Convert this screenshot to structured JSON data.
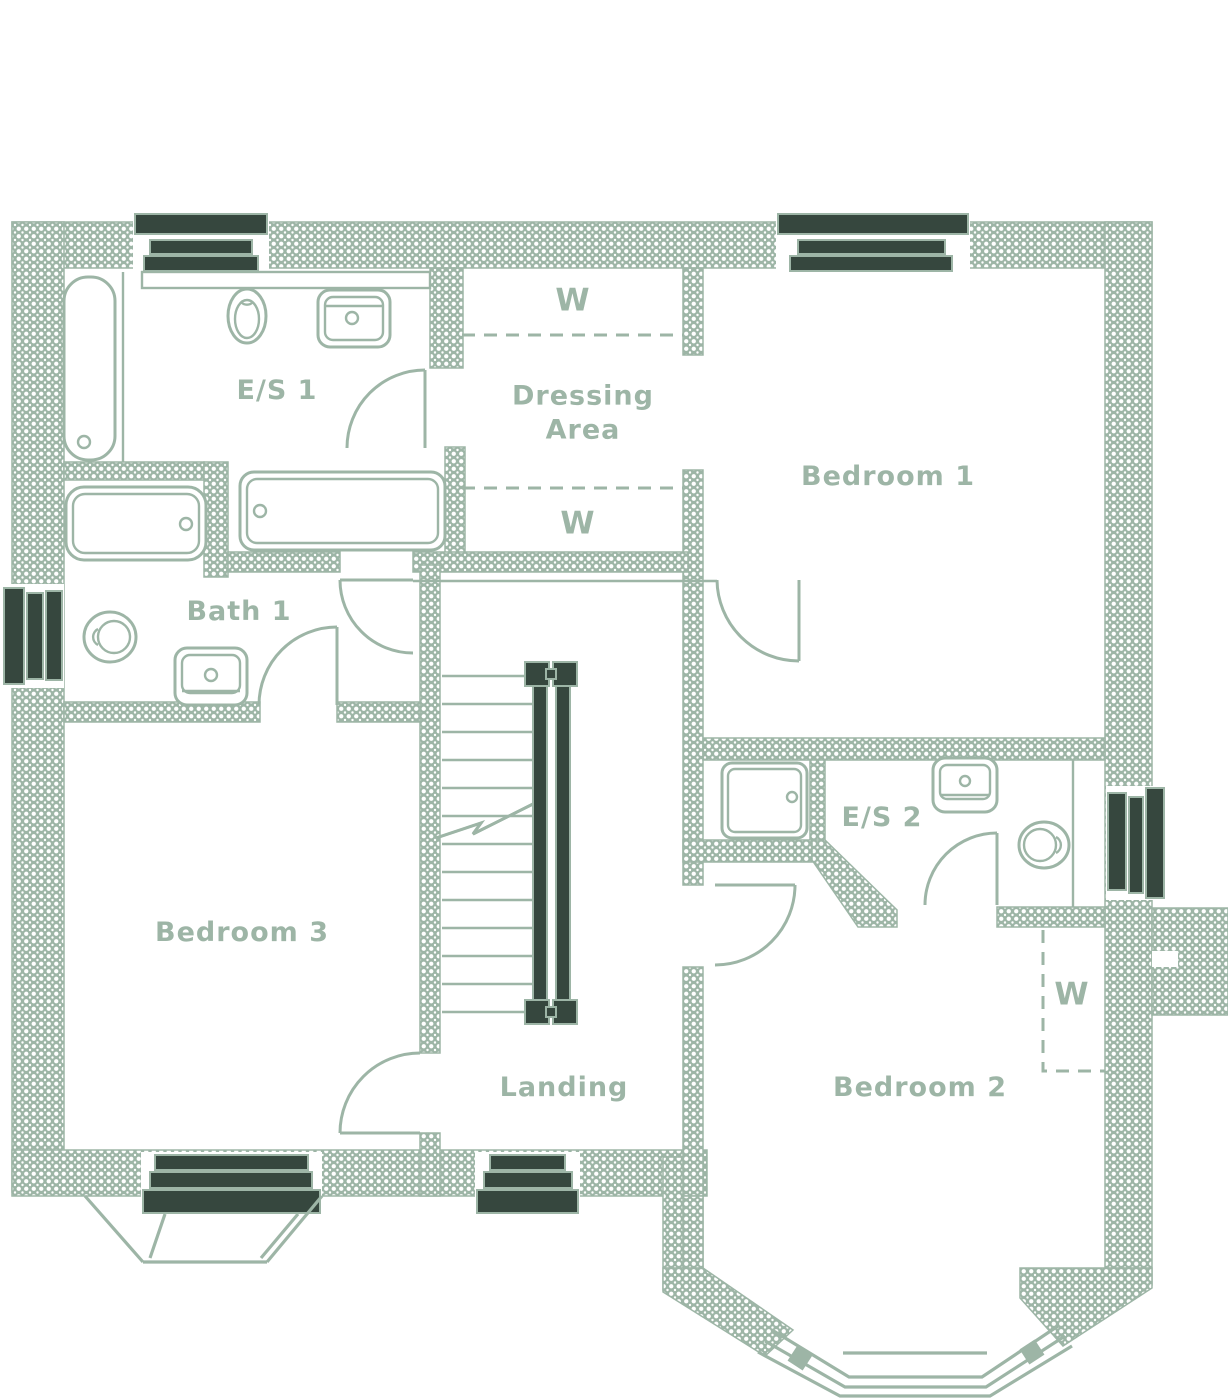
{
  "colors": {
    "line": "#9db5a6",
    "window_dark": "#36473e",
    "background": "#ffffff"
  },
  "rooms": {
    "es1": {
      "label": "E/S 1",
      "fixtures": [
        "bath",
        "toilet",
        "basin",
        "counter",
        "second-bath"
      ]
    },
    "dressing": {
      "label_line1": "Dressing",
      "label_line2": "Area"
    },
    "bedroom1": {
      "label": "Bedroom 1",
      "fixtures": []
    },
    "bath1": {
      "label": "Bath 1",
      "fixtures": [
        "bath",
        "toilet",
        "basin"
      ]
    },
    "bedroom3": {
      "label": "Bedroom 3",
      "fixtures": []
    },
    "landing": {
      "label": "Landing",
      "fixtures": [
        "staircase"
      ]
    },
    "es2": {
      "label": "E/S 2",
      "fixtures": [
        "shower-tray",
        "basin",
        "toilet"
      ]
    },
    "bedroom2": {
      "label": "Bedroom 2",
      "fixtures": []
    }
  },
  "wardrobes": {
    "dressing_top": {
      "label": "W",
      "location": "dressing-area-top"
    },
    "dressing_bottom": {
      "label": "W",
      "location": "dressing-area-bottom"
    },
    "bedroom2": {
      "label": "W",
      "location": "bedroom-2"
    }
  },
  "stairs": {
    "treads": 13,
    "location": "landing",
    "handrails": 2
  },
  "windows": [
    "es1-top",
    "bedroom1-top",
    "bath1-left",
    "es2-right",
    "bedroom3-bottom",
    "landing-bottom"
  ],
  "bay_windows": [
    "bedroom3-bottom",
    "bedroom2-bottom"
  ],
  "doors": [
    "es1-door",
    "bath1-door",
    "landing-corridor-door",
    "bedroom1-door",
    "bedroom3-door",
    "bedroom2-door",
    "es2-door"
  ]
}
